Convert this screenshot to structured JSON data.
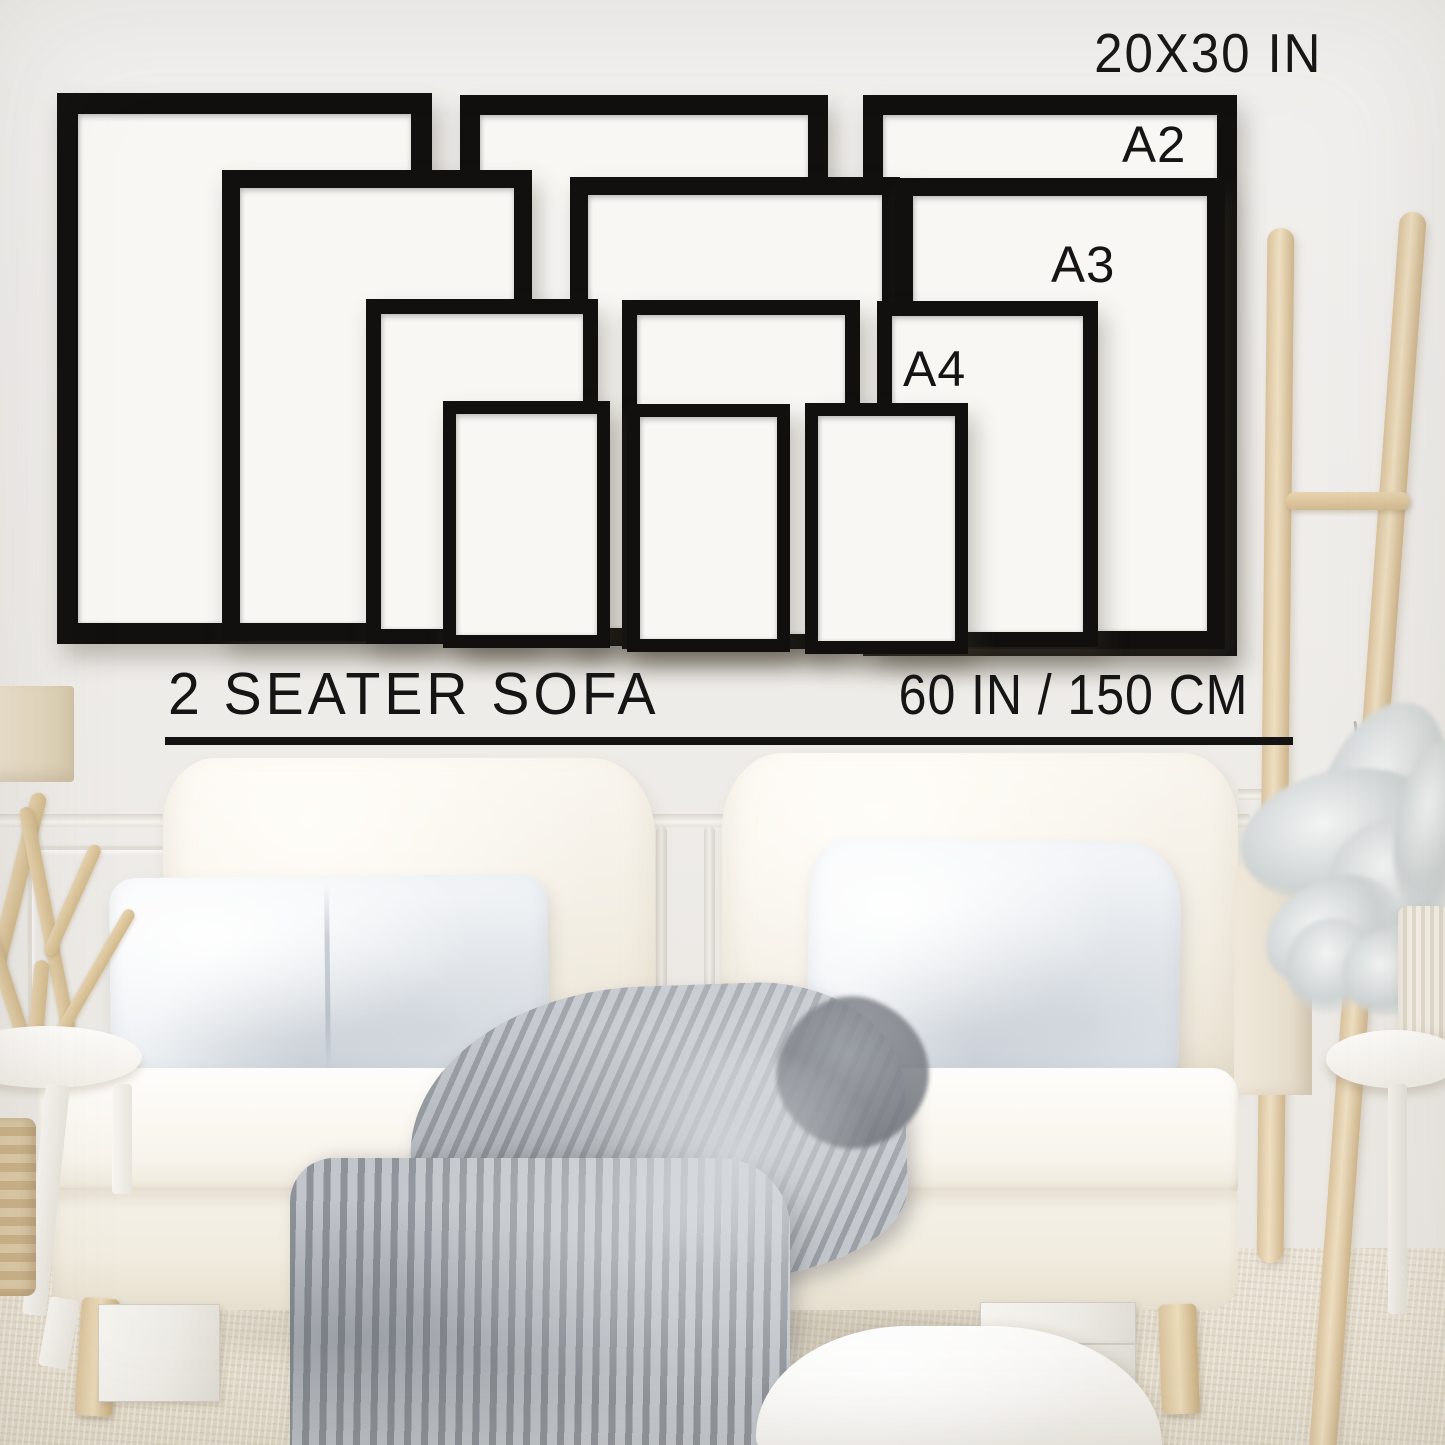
{
  "size_guide": {
    "wall_text": {
      "top_size": "20X30 IN",
      "a2": "A2",
      "a3": "A3",
      "a4": "A4"
    },
    "sofa_text": {
      "label": "2 SEATER SOFA",
      "width": "60 IN / 150 CM"
    },
    "colors": {
      "frame": "#11100f",
      "paper": "#f8f7f4",
      "text": "#151515"
    },
    "frames": [
      {
        "id": "20x30-left",
        "size": "20X30",
        "x": 57,
        "y": 93,
        "w": 375,
        "h": 551,
        "border": 21
      },
      {
        "id": "20x30-middle",
        "size": "20X30",
        "x": 460,
        "y": 95,
        "w": 368,
        "h": 551,
        "border": 20
      },
      {
        "id": "20x30-right",
        "size": "20X30",
        "x": 863,
        "y": 95,
        "w": 374,
        "h": 561,
        "border": 20
      },
      {
        "id": "a2-left",
        "size": "A2",
        "x": 222,
        "y": 170,
        "w": 310,
        "h": 471,
        "border": 18
      },
      {
        "id": "a2-middle",
        "size": "A2",
        "x": 570,
        "y": 177,
        "w": 330,
        "h": 469,
        "border": 18
      },
      {
        "id": "a2-right",
        "size": "A2",
        "x": 895,
        "y": 178,
        "w": 330,
        "h": 471,
        "border": 18
      },
      {
        "id": "a3-left",
        "size": "A3",
        "x": 366,
        "y": 299,
        "w": 232,
        "h": 345,
        "border": 15
      },
      {
        "id": "a3-middle",
        "size": "A3",
        "x": 622,
        "y": 300,
        "w": 238,
        "h": 349,
        "border": 15
      },
      {
        "id": "a3-right",
        "size": "A3",
        "x": 877,
        "y": 301,
        "w": 221,
        "h": 346,
        "border": 15
      },
      {
        "id": "a4-left",
        "size": "A4",
        "x": 443,
        "y": 401,
        "w": 167,
        "h": 247,
        "border": 13
      },
      {
        "id": "a4-middle",
        "size": "A4",
        "x": 627,
        "y": 404,
        "w": 163,
        "h": 248,
        "border": 13
      },
      {
        "id": "a4-right",
        "size": "A4",
        "x": 805,
        "y": 403,
        "w": 163,
        "h": 251,
        "border": 13
      }
    ]
  },
  "scene": {
    "colors": {
      "wall": "#efedea",
      "sofa_fabric": "#f7f3ea",
      "pillow_fabric": "#f1f3f6",
      "blanket": "#a9adb2",
      "ladder_wood": "#ddc7a1",
      "carpet": "#e3dccd"
    }
  }
}
